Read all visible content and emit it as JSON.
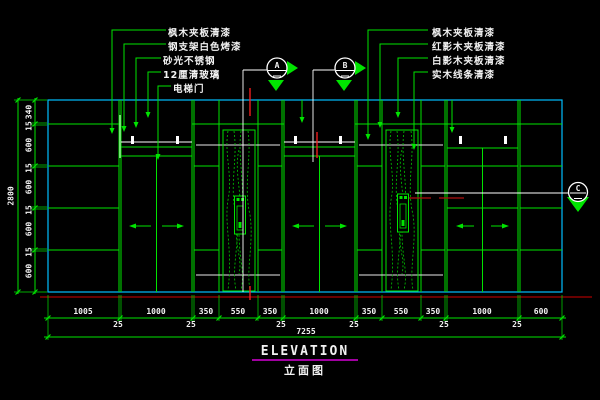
{
  "title": {
    "main": "ELEVATION",
    "sub": "立面图"
  },
  "colors": {
    "background": "#000000",
    "line_green": "#00e400",
    "frame_cyan": "#00bfff",
    "cut_white": "#ffffff",
    "center_red": "#ff2020",
    "floor_dark_red": "#8b0000",
    "title_underline_magenta": "#a000a0",
    "text_white": "#f2f2f2"
  },
  "annotations": {
    "left_labels": [
      "枫木夹板清漆",
      "钢支架白色烤漆",
      "砂光不锈钢",
      "12厘清玻璃",
      "电梯门"
    ],
    "right_labels": [
      "枫木夹板清漆",
      "红影木夹板清漆",
      "白影木夹板清漆",
      "实木线条清漆"
    ]
  },
  "section_markers": {
    "a": "A",
    "b": "B",
    "c": "C"
  },
  "dimensions": {
    "horizontal": {
      "segments": [
        "1005",
        "1000",
        "350",
        "550",
        "350",
        "1000",
        "350",
        "550",
        "350",
        "1000",
        "600"
      ],
      "joints": [
        "25",
        "25",
        "25",
        "25",
        "25",
        "25"
      ],
      "total": "7255"
    },
    "vertical": {
      "segments": [
        "340",
        "600",
        "600",
        "600",
        "600"
      ],
      "joints": [
        "15",
        "15",
        "15",
        "15"
      ],
      "total": "2800"
    }
  }
}
